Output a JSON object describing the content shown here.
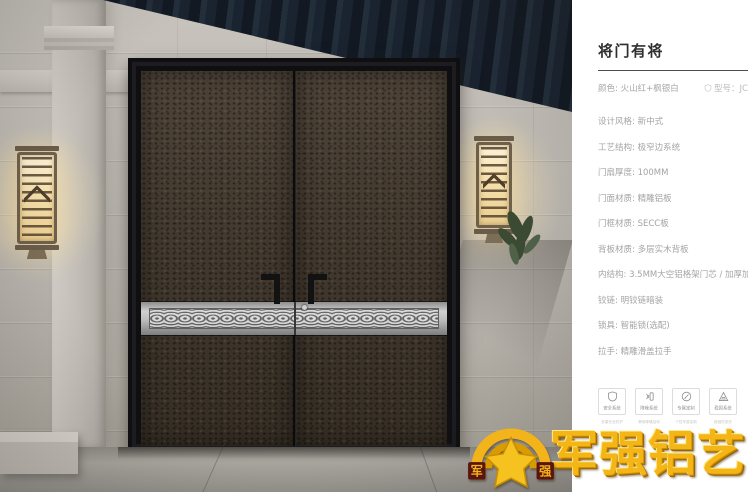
{
  "panel": {
    "title": "将门有将",
    "color_label": "颜色: 火山红+枫银白",
    "model_label": "型号：JC",
    "specs": [
      "设计风格: 新中式",
      "工艺结构: 极窄边系统",
      "门扇厚度: 100MM",
      "门面材质: 精雕铝板",
      "门框材质: SECC板",
      "背板材质: 多层实木背板",
      "内结构: 3.5MM大空铝格架门芯 / 加厚加密航空铝扣条",
      "铰链: 明铰链暗装",
      "锁具: 智能锁(选配)",
      "拉手: 精雕滑盖拉手"
    ],
    "features": [
      {
        "icon": "shield-icon",
        "label": "安全系统",
        "caption": "多重安全防护"
      },
      {
        "icon": "sound-icon",
        "label": "降噪系统",
        "caption": "静音降噪结构"
      },
      {
        "icon": "pen-icon",
        "label": "专属定制",
        "caption": "个性专属定制"
      },
      {
        "icon": "triangle-icon",
        "label": "稳固系统",
        "caption": "稳固防变形"
      }
    ]
  },
  "logo": {
    "brand": "军强铝艺",
    "emblem_left": "军",
    "emblem_right": "强"
  },
  "colors": {
    "brand_gold": "#f4b517",
    "door_leaf": "#483e33",
    "band_silver": "#c9c9c9",
    "beam_dark": "#1a2330",
    "wall_gray": "#b8b4ad",
    "lamp_glow": "#f6e0ac",
    "panel_bg": "#ffffff",
    "spec_text": "#a4a4a4",
    "title_text": "#2f2f2f"
  }
}
